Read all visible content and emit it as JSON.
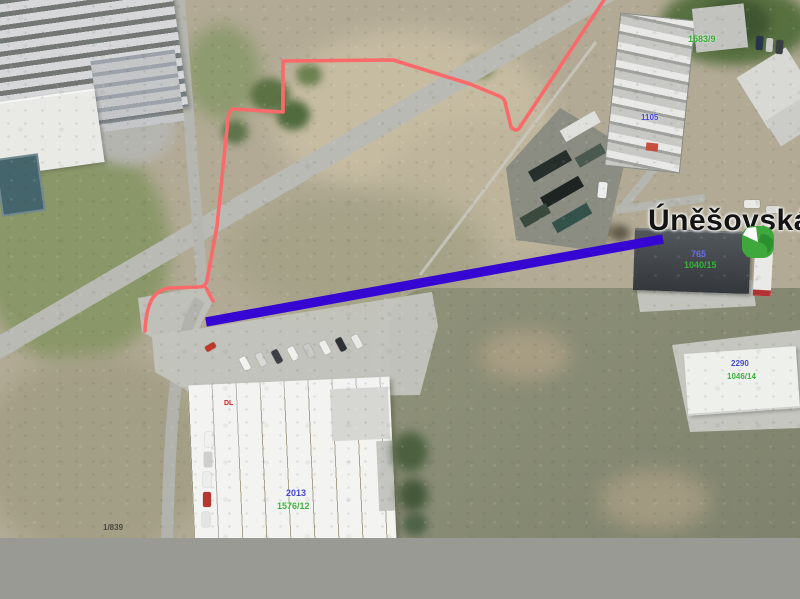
{
  "window": {
    "width": 800,
    "height": 599
  },
  "map": {
    "street_label": "Úněšovská",
    "cadastral_labels": {
      "topright_green": "1583/9",
      "mid_building_blue": "1105",
      "east_building_blue": "765",
      "east_building_green": "1040/15",
      "southeast_blue": "2290",
      "southeast_green": "1046/14",
      "warehouse_blue": "2013",
      "warehouse_green": "1576/12",
      "bottomleft_dark": "1/839",
      "warehouse_red": "DL"
    },
    "overlays": {
      "highlighted_route_color": "#3606d2",
      "parcel_boundary_color": "#fa6a6a",
      "marker_color": "#3fa83c"
    },
    "label_colors": {
      "green": "#2fae2e",
      "blue": "#4646d6",
      "red": "#cc2222",
      "dark": "#4a4a42"
    },
    "background": {
      "footer_gray": "#9a9a94"
    }
  }
}
